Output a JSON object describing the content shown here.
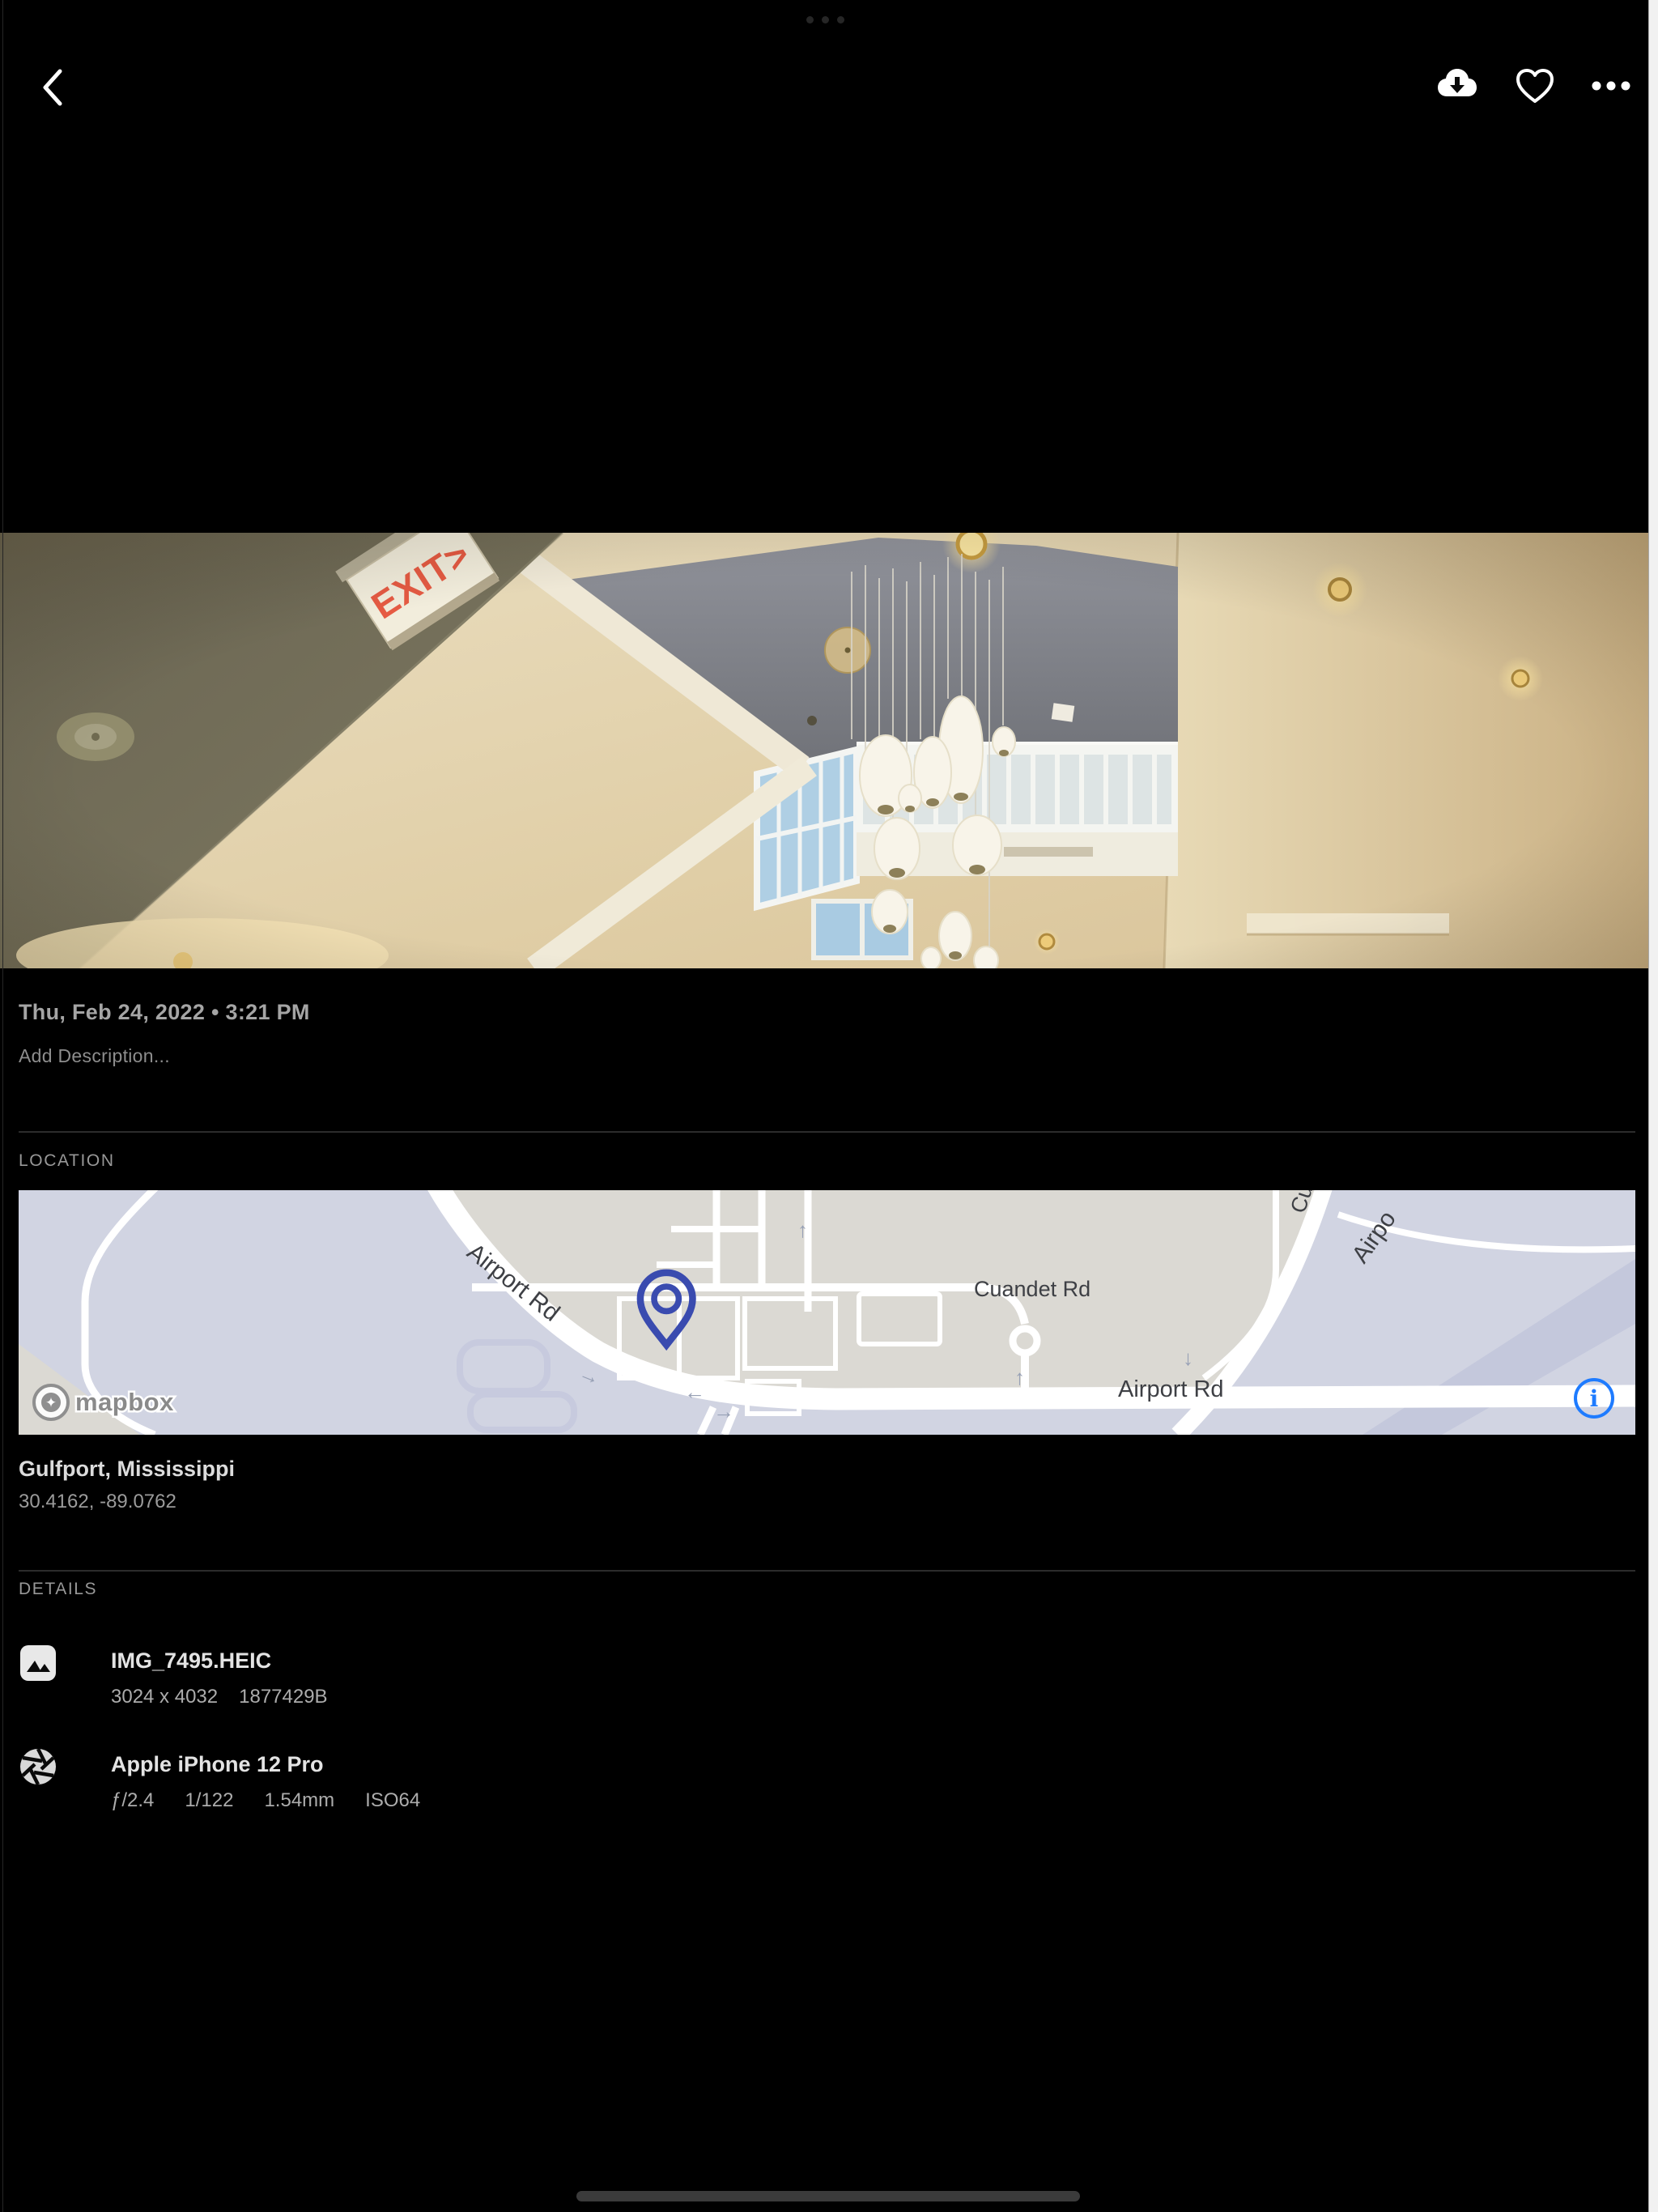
{
  "toolbar": {
    "back": "chevron-left",
    "download": "cloud-download",
    "favorite": "heart",
    "more": "ellipsis"
  },
  "photo_meta": {
    "datetime_label": "Thu, Feb 24, 2022 • 3:21 PM",
    "description_placeholder": "Add Description..."
  },
  "photo_content": {
    "exit_sign_text": "EXIT>"
  },
  "location": {
    "heading": "LOCATION",
    "place": "Gulfport, Mississippi",
    "coordinates": "30.4162, -89.0762",
    "map": {
      "attribution": "mapbox",
      "info_glyph": "i",
      "labels": {
        "airport_rd_nw": "Airport Rd",
        "cuandet_rd": "Cuandet Rd",
        "airport_rd_s": "Airport Rd",
        "partial_cu": "Cu",
        "partial_airport": "Airpo"
      }
    }
  },
  "details": {
    "heading": "DETAILS",
    "file": {
      "name": "IMG_7495.HEIC",
      "dimensions": "3024 x 4032",
      "size": "1877429B"
    },
    "camera": {
      "name": "Apple iPhone 12 Pro",
      "aperture": "ƒ/2.4",
      "shutter": "1/122",
      "focal_length": "1.54mm",
      "iso": "ISO64"
    }
  },
  "colors": {
    "accent_blue": "#1E7BFF",
    "pin_indigo": "#3A4BAF",
    "map_land": "#DBD9D3",
    "map_water": "#D1D4E2"
  }
}
